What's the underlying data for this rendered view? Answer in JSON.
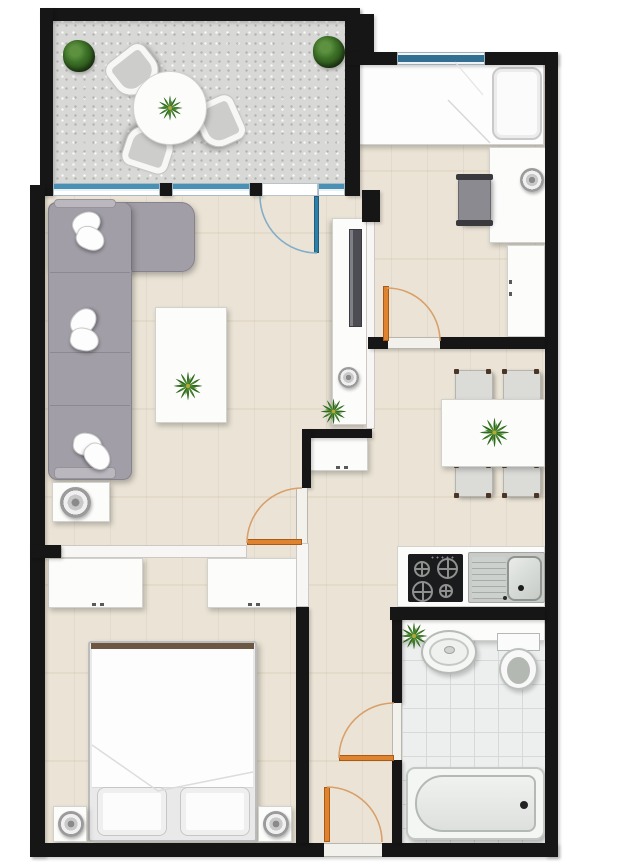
{
  "meta": {
    "title": "Apartment floor plan",
    "view": "top-down 2D rendered plan",
    "canvas_width": 640,
    "canvas_height": 865
  },
  "palette": {
    "wall_black": "#161616",
    "wall_white": "#f7f6f4",
    "wood_floor": "#ebe4d6",
    "concrete_floor": "#d8d9d6",
    "tile_floor": "#edefee",
    "door_orange": "#e0832f",
    "swing_arc": "#d8a06b",
    "glass_blue": "#2e7fa8",
    "sofa_gray": "#a29ea7",
    "plant_green": "#2e6b1f",
    "plant_center": "#b5a83b",
    "stove_black": "#1a1b1d",
    "furniture_white": "#fcfcfb"
  },
  "rooms": [
    {
      "id": "balcony",
      "name": "Balcony terrace",
      "floor": "concrete",
      "furniture": [
        "round bistro table with potted plant",
        "three shell chairs",
        "two green bushes"
      ]
    },
    {
      "id": "living-room",
      "name": "Living room",
      "floor": "light wood",
      "furniture": [
        "L-shaped gray sofa with white pillows",
        "white coffee table with plant",
        "media cabinet with TV and speaker",
        "side table with speaker"
      ]
    },
    {
      "id": "small-bedroom",
      "name": "Small bedroom / study (top right)",
      "floor": "light wood",
      "furniture": [
        "single bed with pillow",
        "desk with lamp",
        "desk chair",
        "wardrobe"
      ]
    },
    {
      "id": "dining-kitchen",
      "name": "Kitchen / dining room",
      "floor": "light wood",
      "furniture": [
        "dining table with plant",
        "four chairs",
        "counter with gas hob and sink",
        "small cabinet"
      ]
    },
    {
      "id": "main-bedroom",
      "name": "Main bedroom (bottom left)",
      "floor": "light wood",
      "furniture": [
        "double bed with two pillows",
        "two dressers",
        "two nightstands with lamps"
      ]
    },
    {
      "id": "bathroom",
      "name": "Bathroom",
      "floor": "tiles",
      "furniture": [
        "vanity with round basin and plant",
        "toilet",
        "bathtub"
      ]
    },
    {
      "id": "hallway",
      "name": "Entrance hall",
      "floor": "light wood",
      "furniture": []
    }
  ],
  "openings": {
    "entry_door": "orange door in bottom wall of hallway",
    "interior_doors": [
      "small-bedroom door",
      "kitchen door",
      "bathroom door"
    ],
    "balcony_glass_wall": "glazed wall with hinged glass door (blue)",
    "window_small_bedroom": "blue window strip in top wall"
  }
}
